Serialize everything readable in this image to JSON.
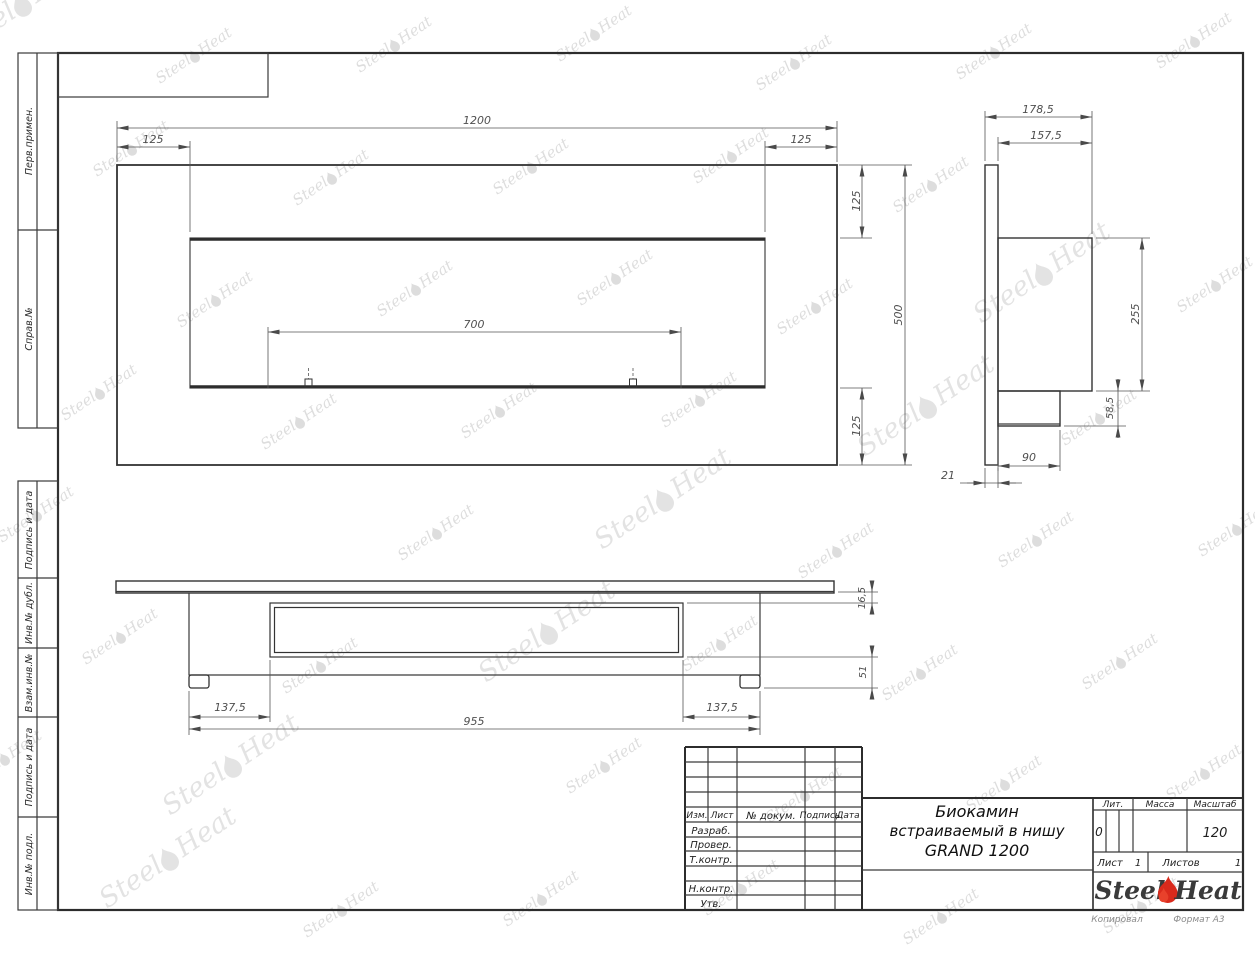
{
  "watermark": {
    "steel": "Steel",
    "heat": "Heat"
  },
  "side_labels": {
    "perv": "Перв.примен.",
    "sprav": "Справ.№",
    "podpis1": "Подпись и дата",
    "inv_dubl": "Инв.№ дубл.",
    "vzam": "Взам.инв.№",
    "podpis2": "Подпись и дата",
    "inv_podl": "Инв.№ подл."
  },
  "dims": {
    "front_width": "1200",
    "front_left": "125",
    "front_right": "125",
    "front_top": "125",
    "front_height": "500",
    "front_bottom": "125",
    "burner_width": "700",
    "side_depth": "178,5",
    "side_box_depth": "157,5",
    "side_box_height": "255",
    "side_lower_height": "58,5",
    "side_lower_depth": "90",
    "side_plate_thickness": "21",
    "bottom_flange": "16,5",
    "bottom_feet": "51",
    "bottom_left": "137,5",
    "bottom_body": "955",
    "bottom_right": "137,5"
  },
  "title_block": {
    "col_izm": "Изм.",
    "col_list": "Лист",
    "col_doc": "№ докум.",
    "col_sign": "Подпись",
    "col_date": "Дата",
    "row_razrab": "Разраб.",
    "row_prover": "Провер.",
    "row_tkontr": "Т.контр.",
    "row_nkontr": "Н.контр.",
    "row_utv": "Утв.",
    "title_line1": "Биокамин",
    "title_line2": "встраиваемый в нишу",
    "title_line3": "GRAND 1200",
    "lit_label": "Лит.",
    "lit_value": "0",
    "mass_label": "Масса",
    "scale_label": "Масштаб",
    "scale_value": "120",
    "list_label": "Лист",
    "list_value": "1",
    "listov_label": "Листов",
    "listov_value": "1",
    "logo_steel": "Steel",
    "logo_heat": "Heat"
  },
  "footer": {
    "copied": "Копировал",
    "format": "Формат А3"
  }
}
